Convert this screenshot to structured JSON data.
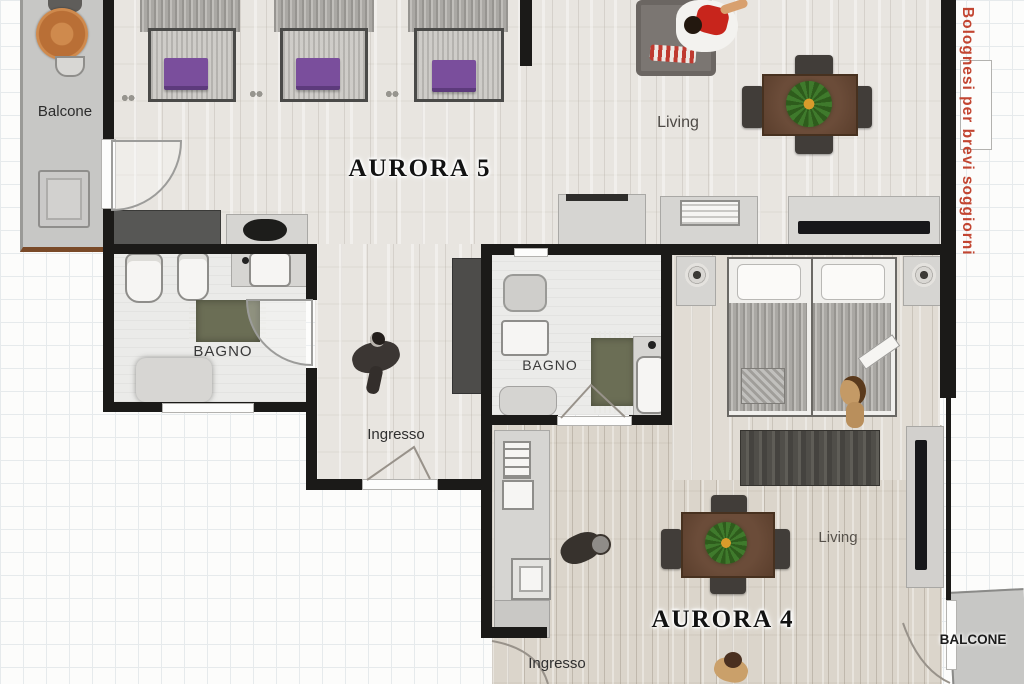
{
  "watermark": {
    "text": "e Bolognesi per brevi soggiorni",
    "color": "#c24531"
  },
  "apartment5": {
    "title": "AURORA 5",
    "balcony_label": "Balcone",
    "living_label": "Living",
    "bathroom_label": "BAGNO",
    "hall_label": "Ingresso"
  },
  "apartment4": {
    "title": "AURORA 4",
    "bathroom_label": "BAGNO",
    "living_label": "Living",
    "hall_label": "Ingresso",
    "balcony_label": "BALCONE"
  },
  "colors": {
    "wall": "#1b1a18",
    "watermark_red": "#c24531",
    "pillow_purple": "#7a4e9c",
    "plant_green": "#3f7a2c",
    "table_wood": "#5f4433",
    "balcony_trim_brown": "#7a4a28",
    "sofa_gray": "#7b7672",
    "shirt_red": "#c8251c"
  }
}
